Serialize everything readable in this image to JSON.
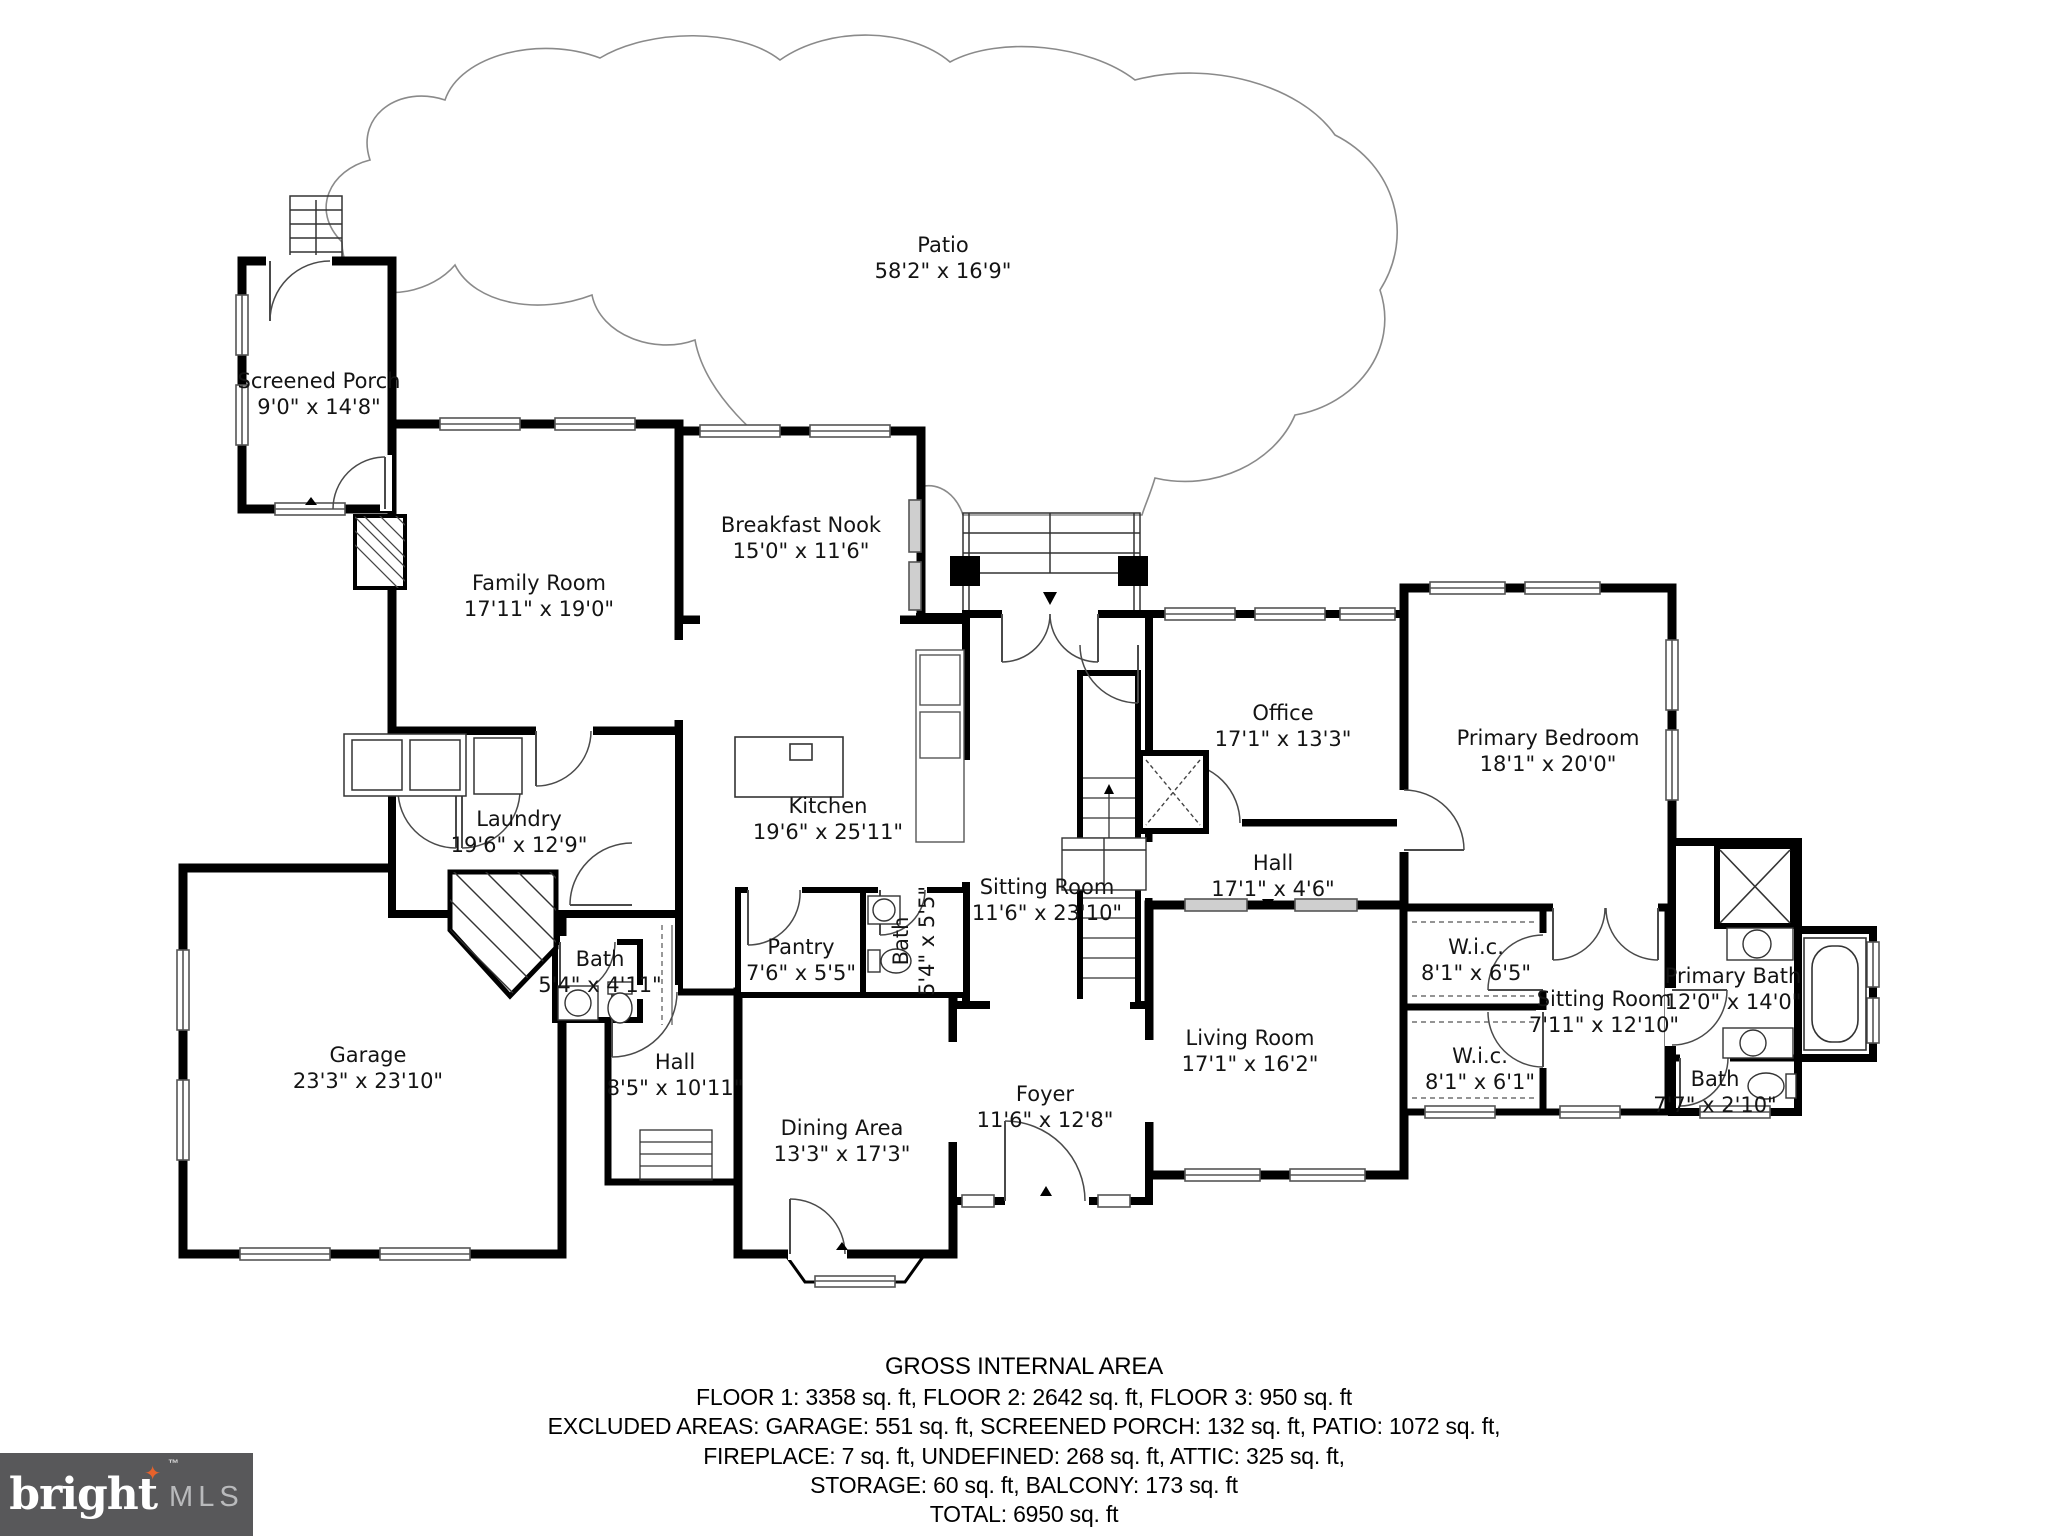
{
  "colors": {
    "wall": "#000000",
    "thin_line": "#3c3c3c",
    "patio_line": "#8a8a8a",
    "window_line": "#555555",
    "logo_bg": "#58585a",
    "logo_accent": "#e8622b",
    "logo_mls_text": "#b9babc"
  },
  "rooms": {
    "patio": {
      "name": "Patio",
      "dims": "58'2\" x 16'9\""
    },
    "screened_porch": {
      "name": "Screened Porch",
      "dims": "9'0\" x 14'8\""
    },
    "family_room": {
      "name": "Family Room",
      "dims": "17'11\" x 19'0\""
    },
    "breakfast_nook": {
      "name": "Breakfast Nook",
      "dims": "15'0\" x 11'6\""
    },
    "office": {
      "name": "Office",
      "dims": "17'1\" x 13'3\""
    },
    "primary_bedroom": {
      "name": "Primary Bedroom",
      "dims": "18'1\" x 20'0\""
    },
    "laundry": {
      "name": "Laundry",
      "dims": "19'6\" x 12'9\""
    },
    "kitchen": {
      "name": "Kitchen",
      "dims": "19'6\" x 25'11\""
    },
    "hall_upper": {
      "name": "Hall",
      "dims": "17'1\" x 4'6\""
    },
    "sitting_room_main": {
      "name": "Sitting Room",
      "dims": "11'6\" x 23'10\""
    },
    "bath_laundry": {
      "name": "Bath",
      "dims": "5'4\" x 4'11\""
    },
    "pantry": {
      "name": "Pantry",
      "dims": "7'6\" x 5'5\""
    },
    "bath_kitchen": {
      "name": "Bath",
      "dims": "5'4\" x 5'5\""
    },
    "wic_upper": {
      "name": "W.i.c.",
      "dims": "8'1\" x 6'5\""
    },
    "sitting_room_primary": {
      "name": "Sitting Room",
      "dims": "7'11\" x 12'10\""
    },
    "primary_bath": {
      "name": "Primary Bath",
      "dims": "12'0\" x 14'0\""
    },
    "garage": {
      "name": "Garage",
      "dims": "23'3\" x 23'10\""
    },
    "hall_lower": {
      "name": "Hall",
      "dims": "8'5\" x 10'11\""
    },
    "living_room": {
      "name": "Living Room",
      "dims": "17'1\" x 16'2\""
    },
    "wic_lower": {
      "name": "W.i.c.",
      "dims": "8'1\" x 6'1\""
    },
    "bath_small": {
      "name": "Bath",
      "dims": "7'7\" x 2'10\""
    },
    "foyer": {
      "name": "Foyer",
      "dims": "11'6\" x 12'8\""
    },
    "dining_area": {
      "name": "Dining Area",
      "dims": "13'3\" x 17'3\""
    }
  },
  "footer": {
    "title": "GROSS INTERNAL AREA",
    "line1": "FLOOR 1: 3358 sq. ft, FLOOR 2: 2642 sq. ft, FLOOR 3: 950 sq. ft",
    "line2": "EXCLUDED AREAS: GARAGE: 551 sq. ft, SCREENED PORCH: 132 sq. ft, PATIO: 1072 sq. ft,",
    "line3": "FIREPLACE: 7 sq. ft, UNDEFINED: 268 sq. ft, ATTIC: 325 sq. ft,",
    "line4": "STORAGE: 60 sq. ft, BALCONY: 173 sq. ft",
    "total": "TOTAL: 6950 sq. ft",
    "disclaimer": "Measurements Are Calculated By Cubicasa Technology. Deemed Highly Reliable But Not Guaranteed."
  },
  "logo": {
    "brand": "bright",
    "tm": "™",
    "suffix": "MLS",
    "star": "✦"
  }
}
